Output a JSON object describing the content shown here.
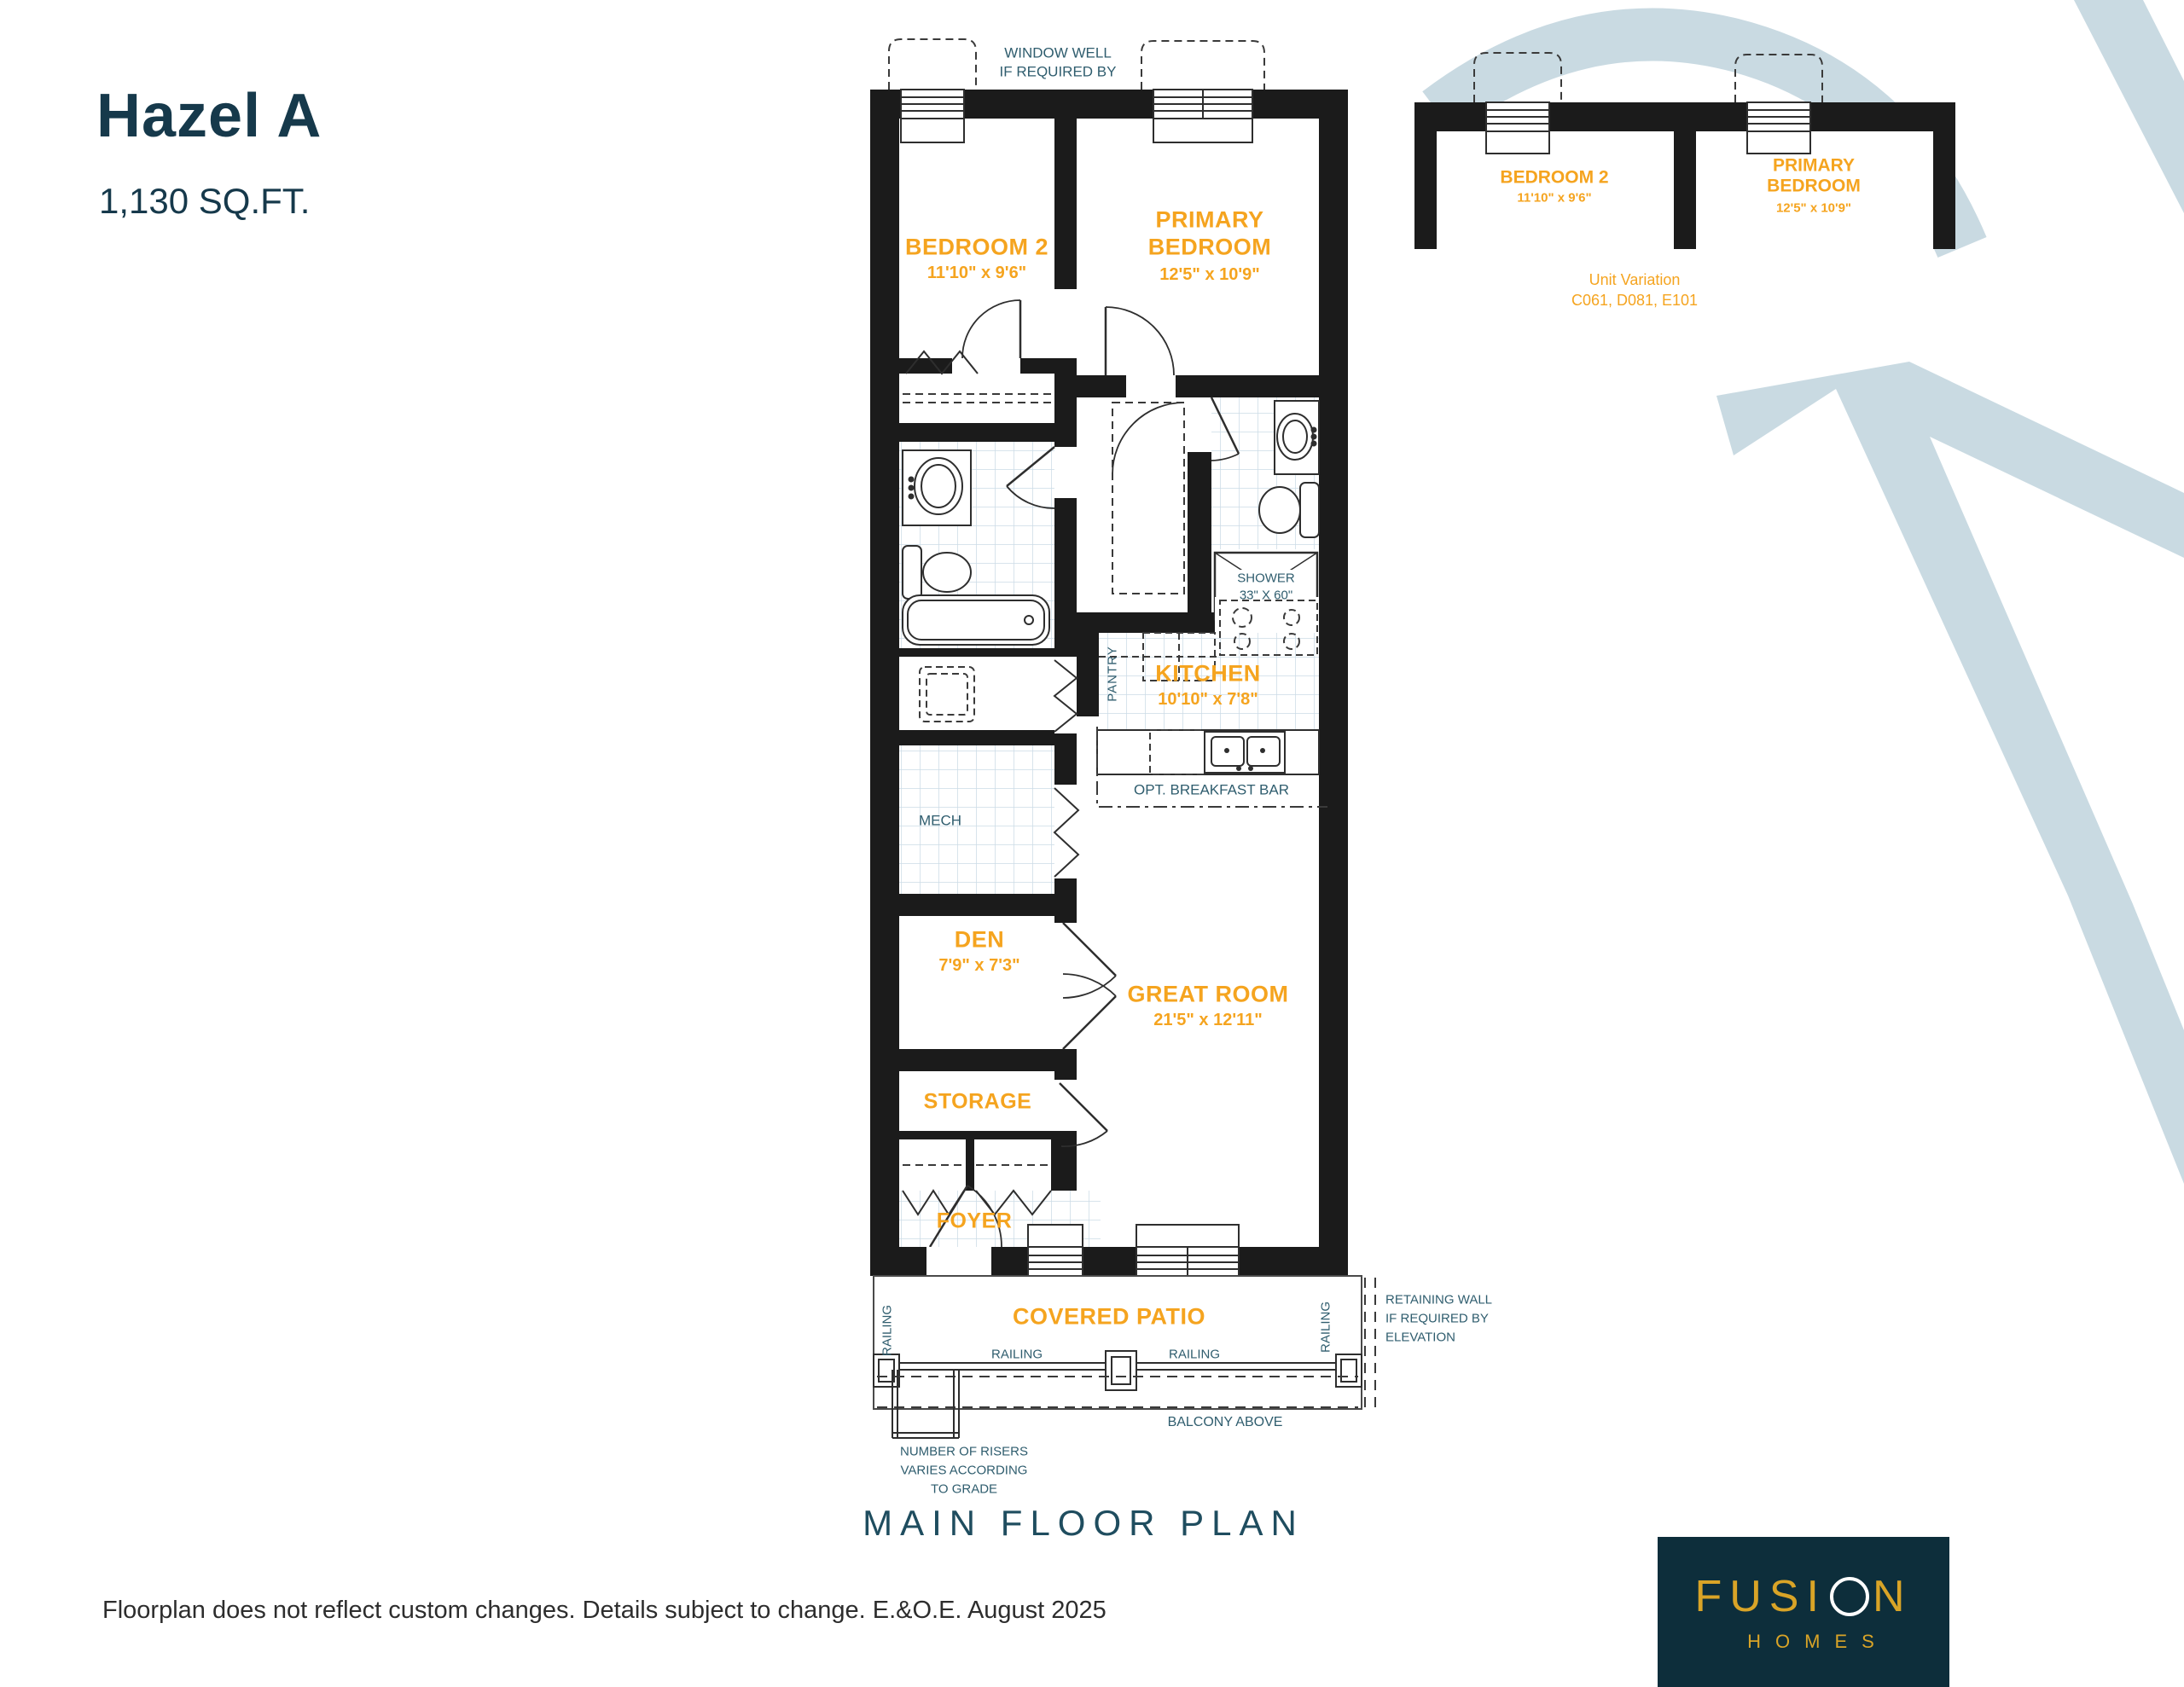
{
  "page": {
    "title_name": "Hazel A",
    "title_area": "1,130 SQ.FT."
  },
  "colors": {
    "accent_orange": "#F5A41F",
    "teal_heading": "#16394B",
    "teal_label": "#2F5D6E",
    "swoosh_blue": "#C9DAE2",
    "wall_black": "#1B1B1B",
    "logo_bg": "#0D2E3B",
    "logo_gold": "#D9A427"
  },
  "main_plan": {
    "rooms": {
      "bedroom2": {
        "name": "BEDROOM 2",
        "dims": "11'10\" x 9'6\""
      },
      "primary": {
        "name_l1": "PRIMARY",
        "name_l2": "BEDROOM",
        "dims": "12'5\" x 10'9\""
      },
      "kitchen": {
        "name": "KITCHEN",
        "dims": "10'10\" x 7'8\""
      },
      "den": {
        "name": "DEN",
        "dims": "7'9\" x 7'3\""
      },
      "great_room": {
        "name": "GREAT ROOM",
        "dims": "21'5\" x 12'11\""
      },
      "storage": {
        "name": "STORAGE"
      },
      "foyer": {
        "name": "FOYER"
      },
      "covered_patio": {
        "name": "COVERED PATIO"
      }
    },
    "annotations": {
      "window_well_l1": "WINDOW WELL",
      "window_well_l2": "IF REQUIRED BY",
      "mech": "MECH",
      "pantry": "PANTRY",
      "shower_l1": "SHOWER",
      "shower_l2": "33\" X 60\"",
      "opt_breakfast_bar": "OPT. BREAKFAST BAR",
      "railing": "RAILING",
      "balcony_above": "BALCONY ABOVE",
      "retaining_l1": "RETAINING WALL",
      "retaining_l2": "IF REQUIRED BY",
      "retaining_l3": "ELEVATION",
      "risers_l1": "NUMBER OF RISERS",
      "risers_l2": "VARIES ACCORDING",
      "risers_l3": "TO GRADE"
    }
  },
  "variation": {
    "bedroom2": {
      "name": "BEDROOM 2",
      "dims": "11'10\" x 9'6\""
    },
    "primary": {
      "name_l1": "PRIMARY",
      "name_l2": "BEDROOM",
      "dims": "12'5\" x 10'9\""
    },
    "caption_l1": "Unit Variation",
    "caption_l2": "C061, D081, E101"
  },
  "footer": {
    "plan_title": "MAIN FLOOR PLAN",
    "disclaimer": "Floorplan does not reflect custom changes. Details subject to change. E.&O.E. August 2025",
    "logo": {
      "brand_prefix": "FUSI",
      "brand_suffix": "N",
      "homes": "HOMES"
    }
  }
}
